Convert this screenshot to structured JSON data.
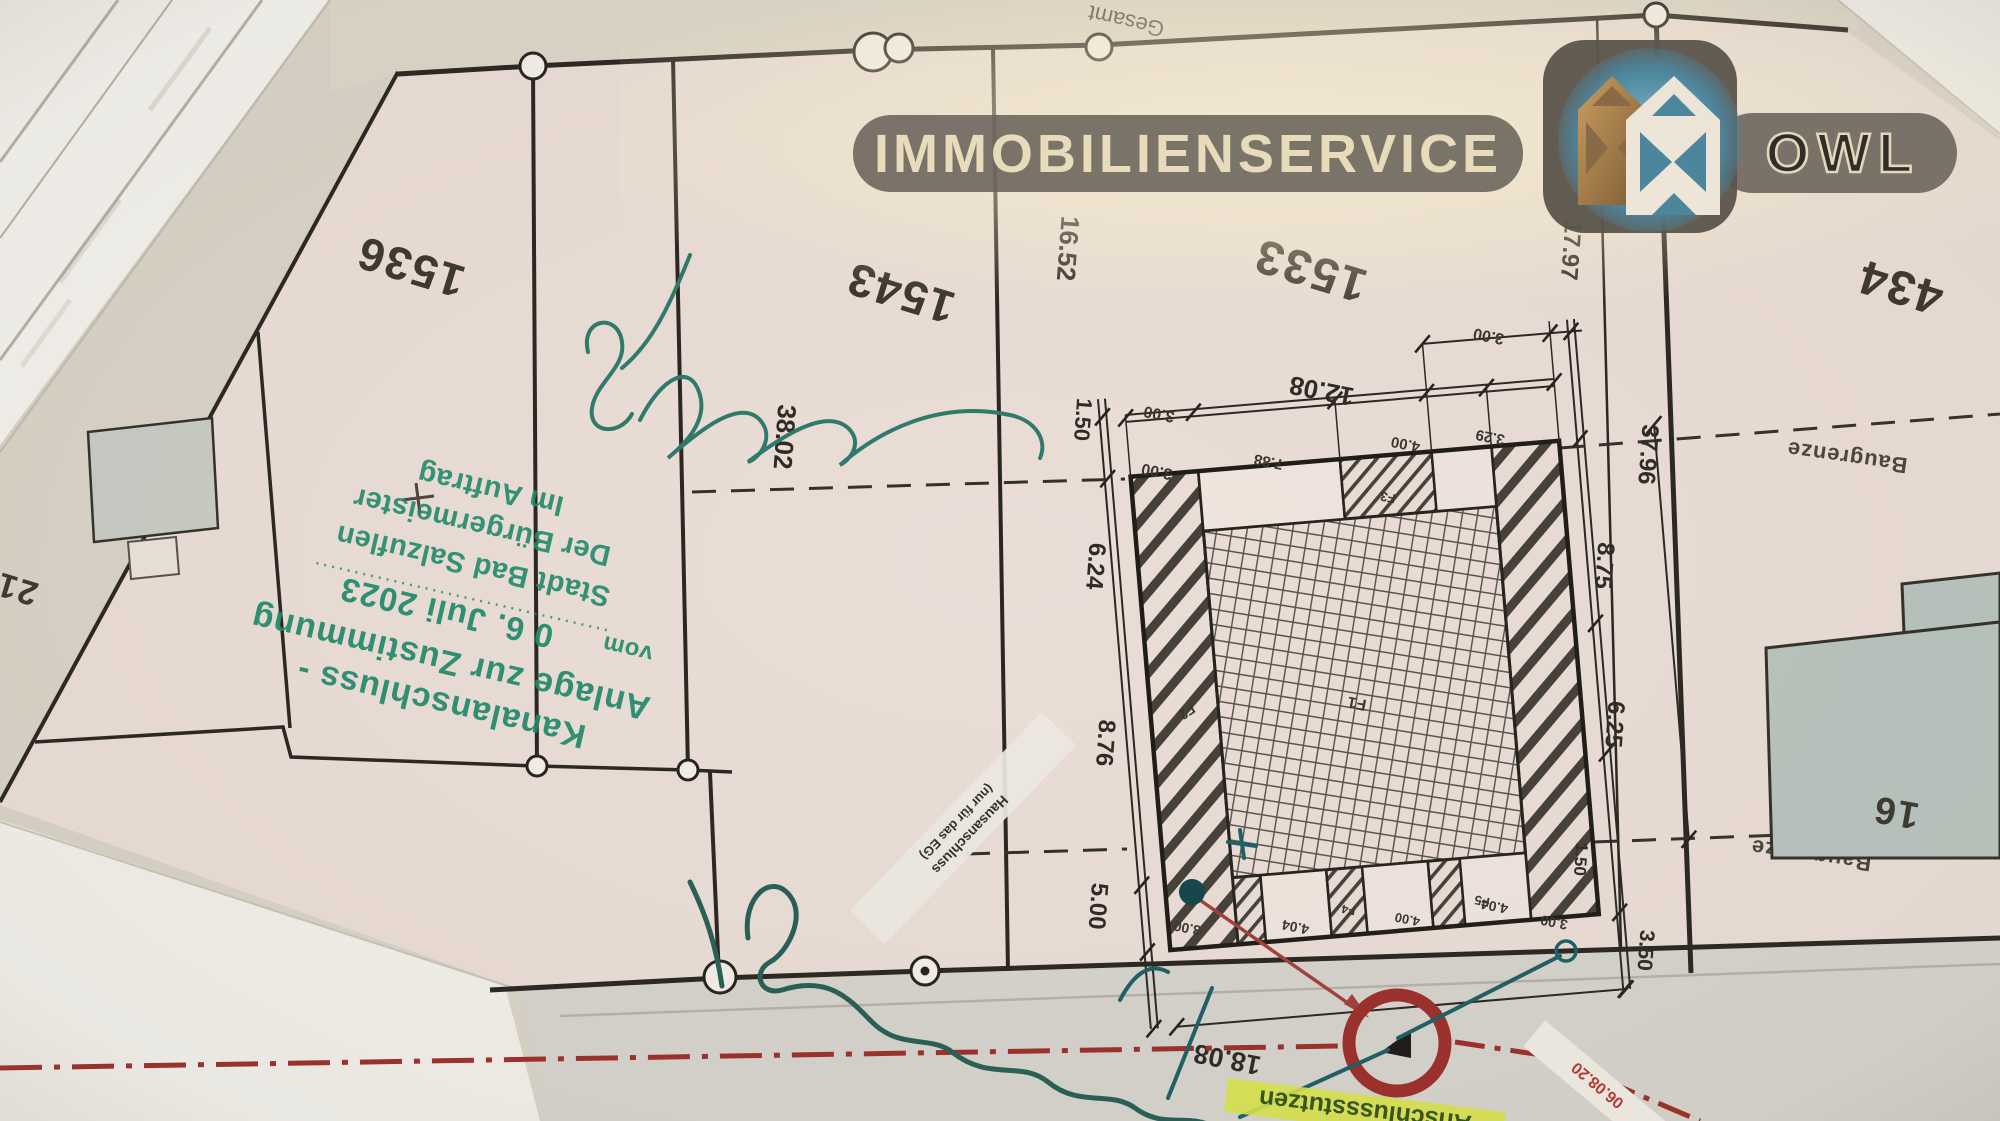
{
  "watermark": {
    "brand": "IMMOBILIENSERVICE",
    "region": "OWL"
  },
  "parcels": {
    "p1536": "1536",
    "p1543": "1543",
    "p1533": "1533",
    "p434": "434",
    "p16": "16",
    "p21": "21"
  },
  "stamp": {
    "line1": "Kanalanschluss -",
    "line2": "Anlage zur Zustimmung",
    "vom": "vom",
    "date": "0 6. Juli 2023",
    "line4": "Stadt Bad Salzuflen",
    "line5": "Der Bürgermeister",
    "line6": "Im Auftrag"
  },
  "labels": {
    "baugrenze": "Baugrenze",
    "gesamt": "Gesamt",
    "band_line1": "Hausanschluss",
    "band_line2": "(nur für das EG)",
    "anschluss": "Anschlussstutzen",
    "red_note": "06.08.20"
  },
  "dims": {
    "d16_52": "16.52",
    "d38_02": "38.02",
    "d12_08": "12.08",
    "d17_97": "17.97",
    "d37_96": "37.96",
    "d8_75": "8.75",
    "d6_25": "6.25",
    "d6_24": "6.24",
    "d8_76": "8.76",
    "d5_00": "5.00",
    "d3_50": "3.50",
    "d18_08": "18.08",
    "d7_88": "7.88",
    "d4_00": "4.00",
    "d3_29": "3.29",
    "d3_00": "3.00",
    "d1_50": "1.50",
    "d4_04": "4.04"
  },
  "rooms": {
    "f1": "F1",
    "f2": "F2",
    "f3": "F3",
    "f4": "F4",
    "f5": "F5"
  },
  "colors": {
    "stamp_green": "#1f8a6b",
    "marker_red": "#9c2f2a",
    "teal": "#1d5f66",
    "highlight": "#d9e34a",
    "paper": "#eaddd6",
    "building": "#b9c4be"
  }
}
